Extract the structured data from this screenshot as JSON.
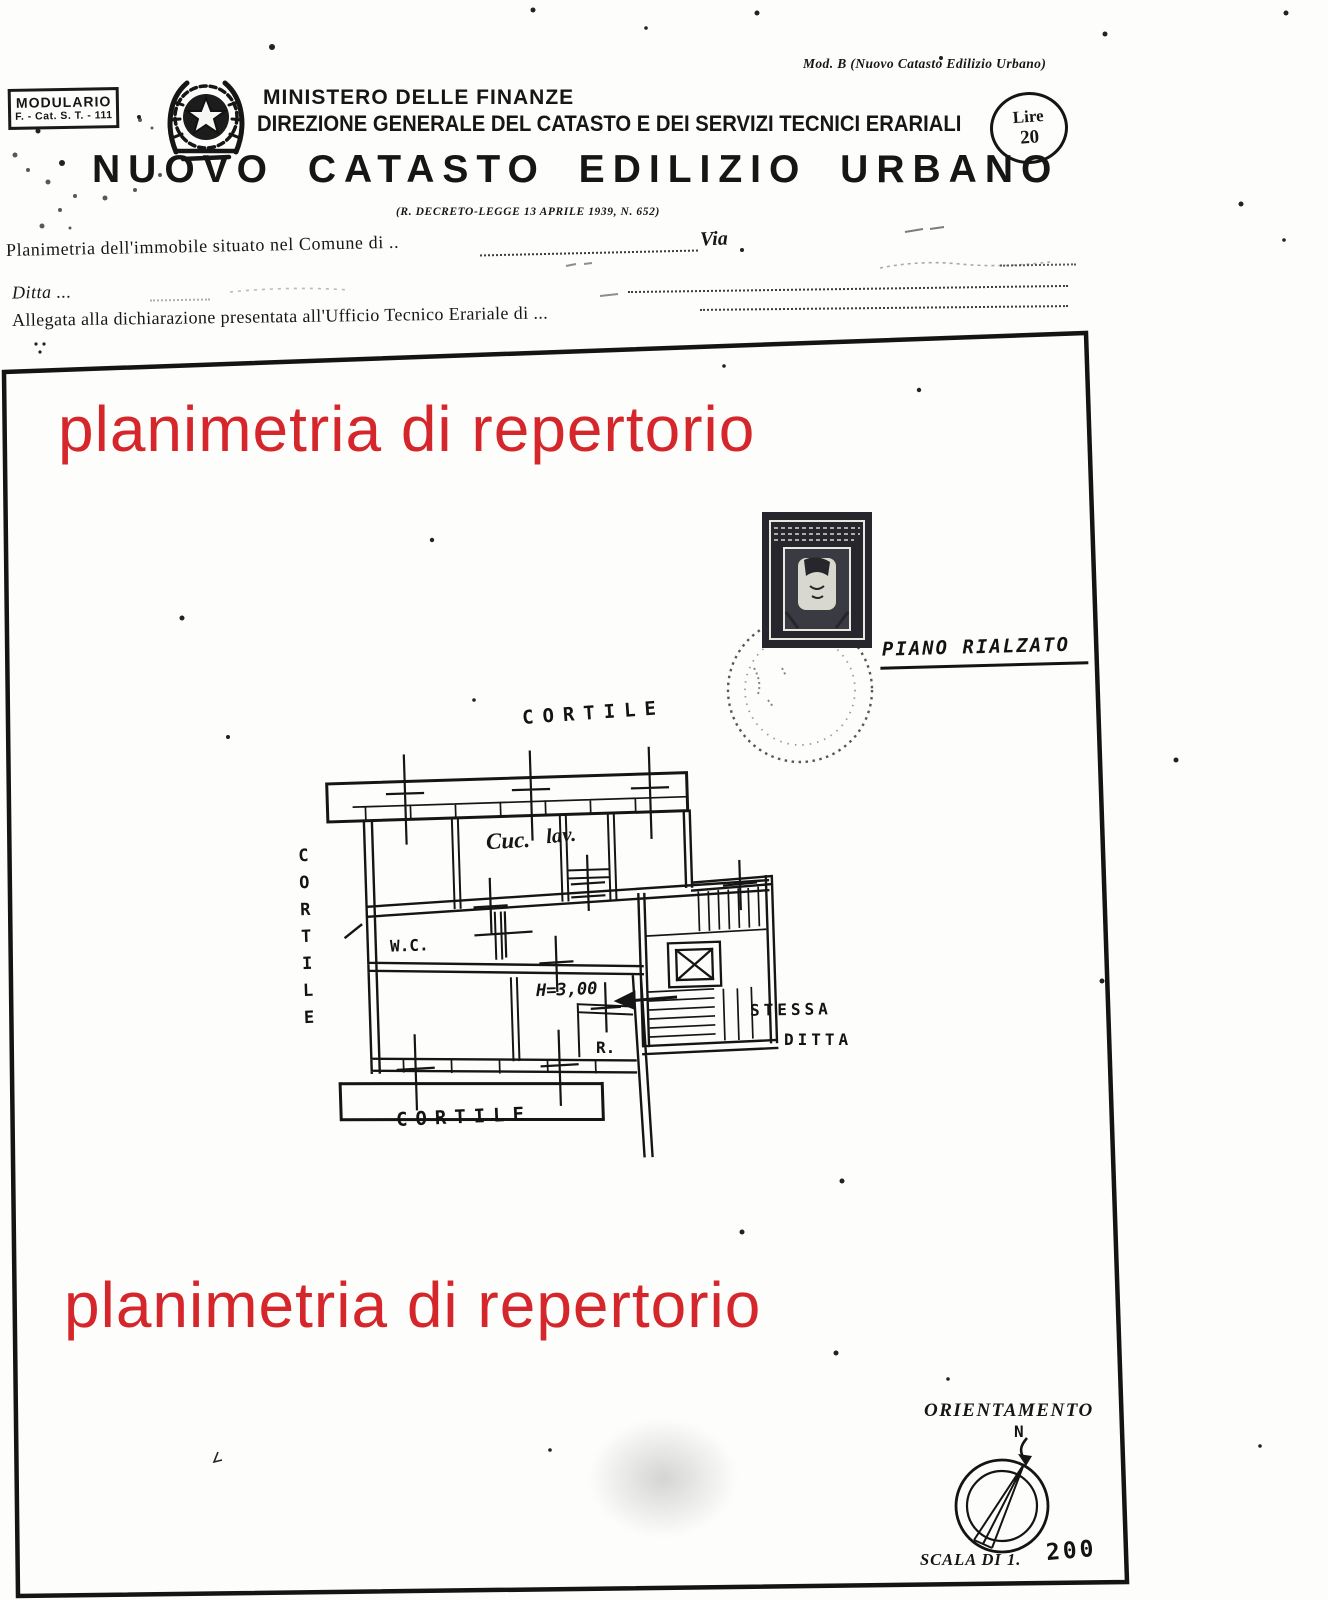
{
  "document": {
    "modulario": {
      "line1": "MODULARIO",
      "line2": "F. - Cat. S. T. - 111"
    },
    "mod_reference": "Mod. B (Nuovo Catasto Edilizio Urbano)",
    "stamp_value": {
      "label": "Lire",
      "amount": "20"
    },
    "ministry": "MINISTERO DELLE FINANZE",
    "directorate": "DIREZIONE GENERALE DEL CATASTO E DEI SERVIZI TECNICI ERARIALI",
    "title": "NUOVO CATASTO EDILIZIO URBANO",
    "decree": "(R. DECRETO-LEGGE 13 APRILE 1939, N. 652)",
    "form": {
      "line1": "Planimetria dell'immobile situato nel Comune di ..",
      "via": "Via",
      "line2": "Ditta ...",
      "line3": "Allegata alla dichiarazione presentata all'Ufficio Tecnico Erariale di ..."
    },
    "watermark": {
      "text": "planimetria di repertorio",
      "color": "#d5262b"
    },
    "plan": {
      "floor": "PIANO RIALZATO",
      "courtyard_top": "CORTILE",
      "courtyard_left": "CORTILE",
      "courtyard_bottom": "CORTILE",
      "kitchen": "Cuc.",
      "laundry": "lav.",
      "wc": "W.C.",
      "height_note": "H=3,00",
      "storage": "R.",
      "adjacent_line1": "STESSA",
      "adjacent_line2": "DITTA"
    },
    "orientation": {
      "label": "ORIENTAMENTO",
      "north": "N"
    },
    "scale": {
      "label": "SCALA DI 1.",
      "value": "200"
    }
  }
}
